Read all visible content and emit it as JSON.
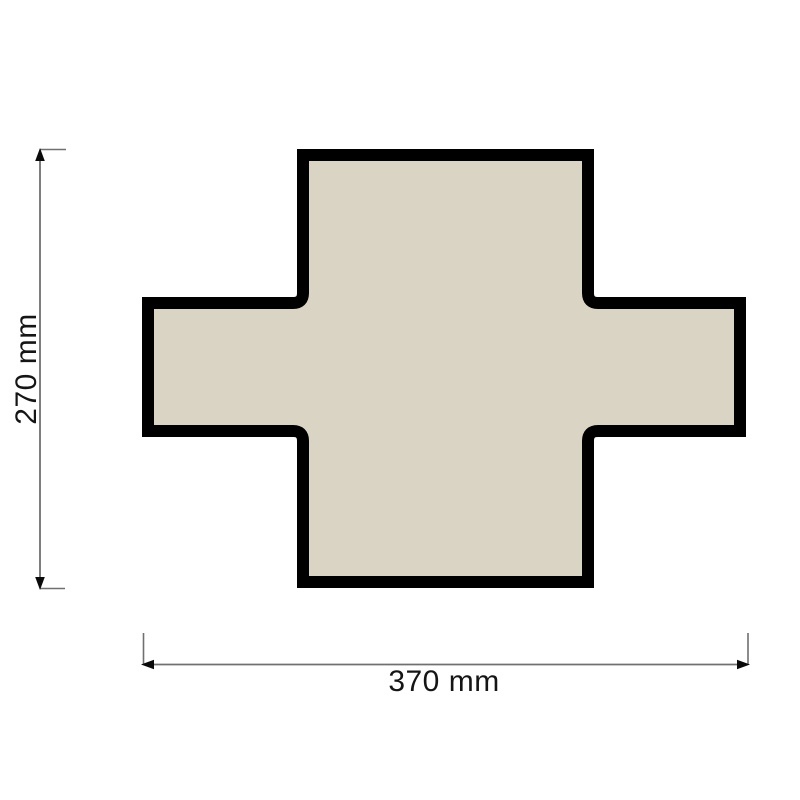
{
  "diagram": {
    "dimensions": {
      "height_label": "270 mm",
      "width_label": "370 mm"
    },
    "colors": {
      "background": "#ffffff",
      "shape_fill": "#dad4c4",
      "shape_border": "#000000",
      "dimension_line": "#707070",
      "arrow": "#0a0a0a",
      "label_text": "#151515"
    }
  }
}
